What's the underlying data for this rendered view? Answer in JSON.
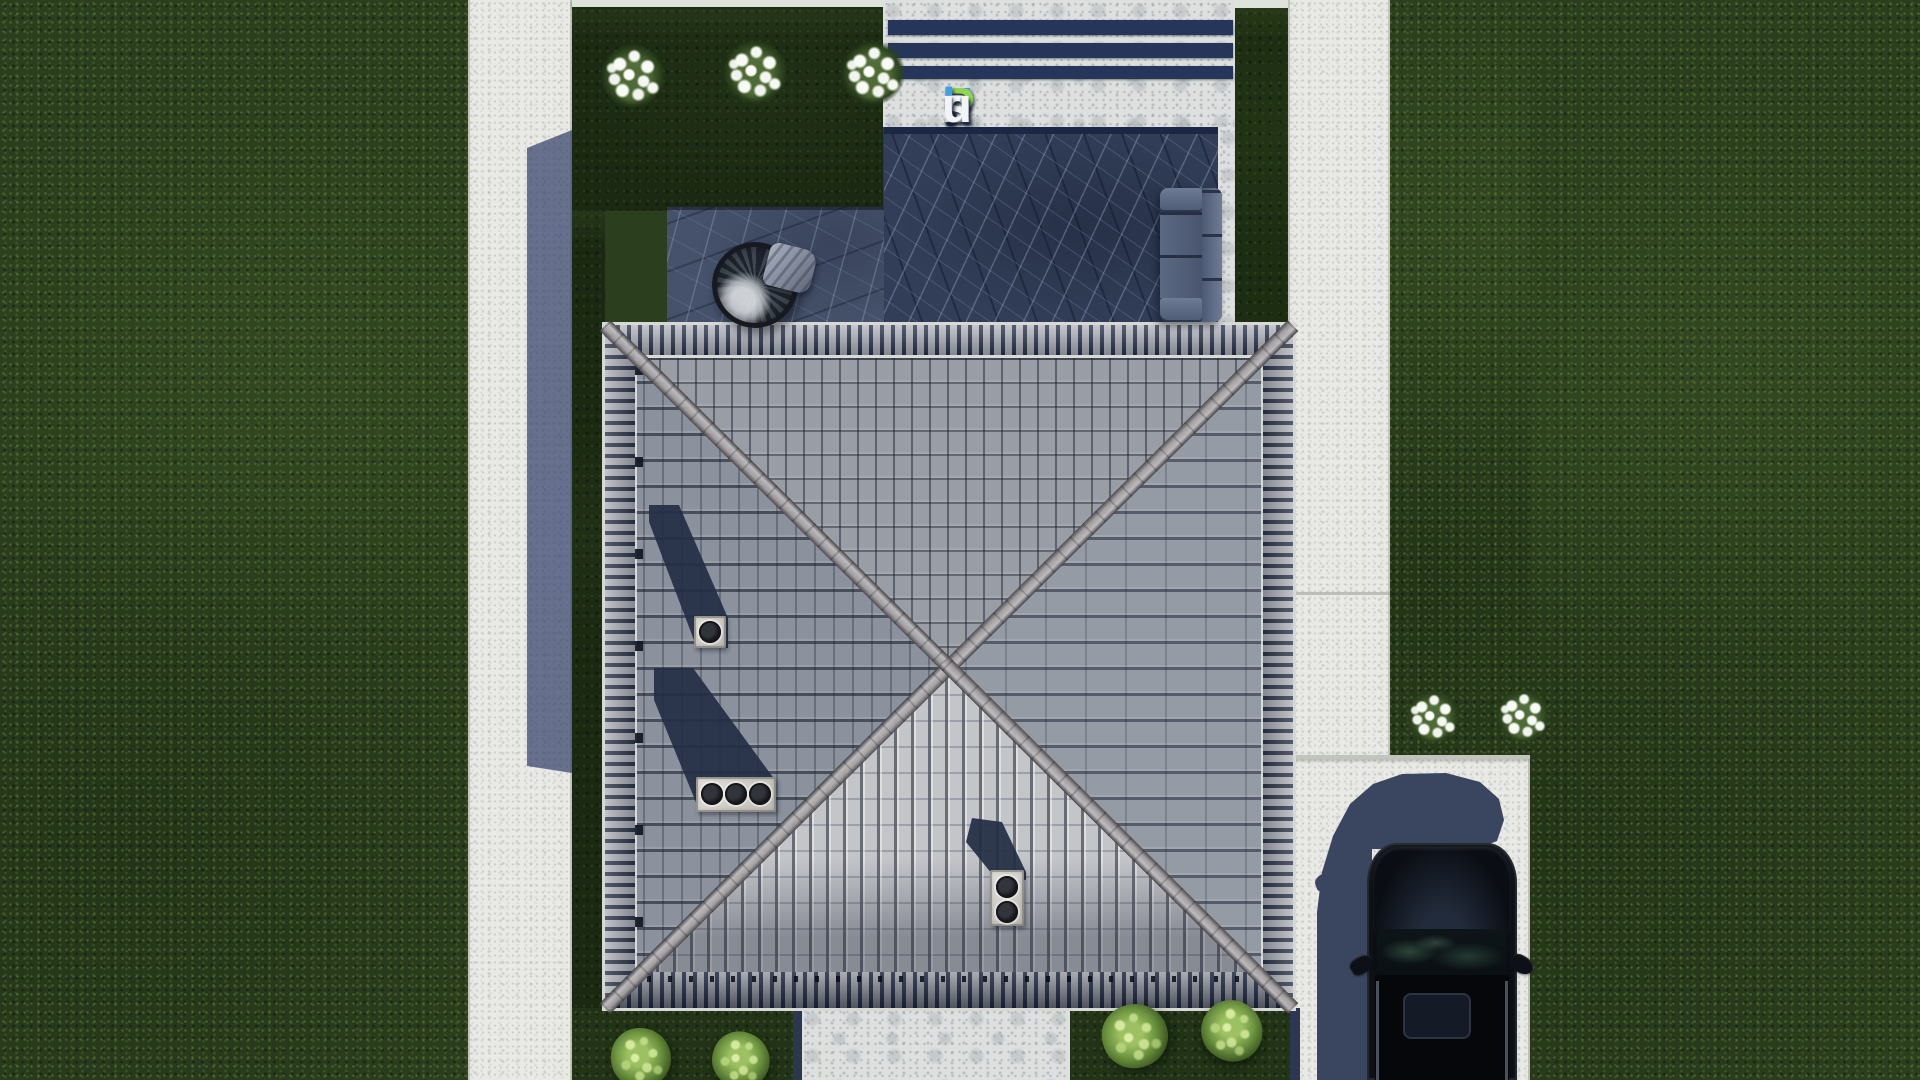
{
  "meta": {
    "description": "Top-down aerial 3D architectural render: hip-roof house with pool terrace, lawns, sidewalks, driveway and black SUV",
    "view": "bird's-eye site plan render"
  },
  "watermark": {
    "text": "FixPlans.ru",
    "letters": [
      {
        "ch": "F",
        "color": "#3fa0e8"
      },
      {
        "ch": "i",
        "color": "#8fd64d"
      },
      {
        "ch": "x",
        "color": "#f2f4f6"
      },
      {
        "ch": "P",
        "color": "#8fd64d"
      },
      {
        "ch": "l",
        "color": "#3fa0e8"
      },
      {
        "ch": "a",
        "color": "#f2f4f6"
      },
      {
        "ch": "n",
        "color": "#f2f4f6"
      },
      {
        "ch": "s",
        "color": "#f2f4f6"
      },
      {
        "ch": ".",
        "color": "#3fa0e8"
      },
      {
        "ch": "r",
        "color": "#f2f4f6"
      },
      {
        "ch": "u",
        "color": "#f2f4f6"
      }
    ]
  },
  "scene": {
    "objects": {
      "house_roof": {
        "type": "hip roof",
        "faces": 4,
        "ridge_shape": "X",
        "tile_color": "#969ca6"
      },
      "chimneys": [
        {
          "pots": 1,
          "face": "west"
        },
        {
          "pots": 3,
          "face": "west"
        },
        {
          "pots": 2,
          "face": "south"
        }
      ],
      "pool": {
        "water_color": "#323e58",
        "deck_stripes": 3,
        "stripe_color": "#26355a"
      },
      "terrace": {
        "stone_color": "#46526b"
      },
      "furniture": [
        "hanging egg chair",
        "outdoor sofa"
      ],
      "car": {
        "color": "#0b0e13",
        "type": "SUV top view",
        "sunroof": true
      },
      "planting": {
        "white_flower_bushes": 5,
        "green_shrubs": 4
      },
      "paving": [
        "left sidewalk",
        "right sidewalk",
        "driveway",
        "garden walkway",
        "pool deck"
      ]
    },
    "colors": {
      "lawn": "#2b3e1d",
      "lawn_shaded": "#1b2912",
      "pavement": "#e9e9e5",
      "deck_stone": "#dde0de",
      "pool_water": "#323e58",
      "terrace_stone": "#46526b",
      "roof_light_face": "#c3c5c9",
      "roof_medium_face": "#969ca6",
      "ridge_cap": "#a5a1a3",
      "cast_shadow": "#3a4660",
      "navy_stripe": "#26355a",
      "car_black": "#0b0e13",
      "flowers_white": "#f4f6f1",
      "shrub_green": "#7ca64f"
    }
  }
}
